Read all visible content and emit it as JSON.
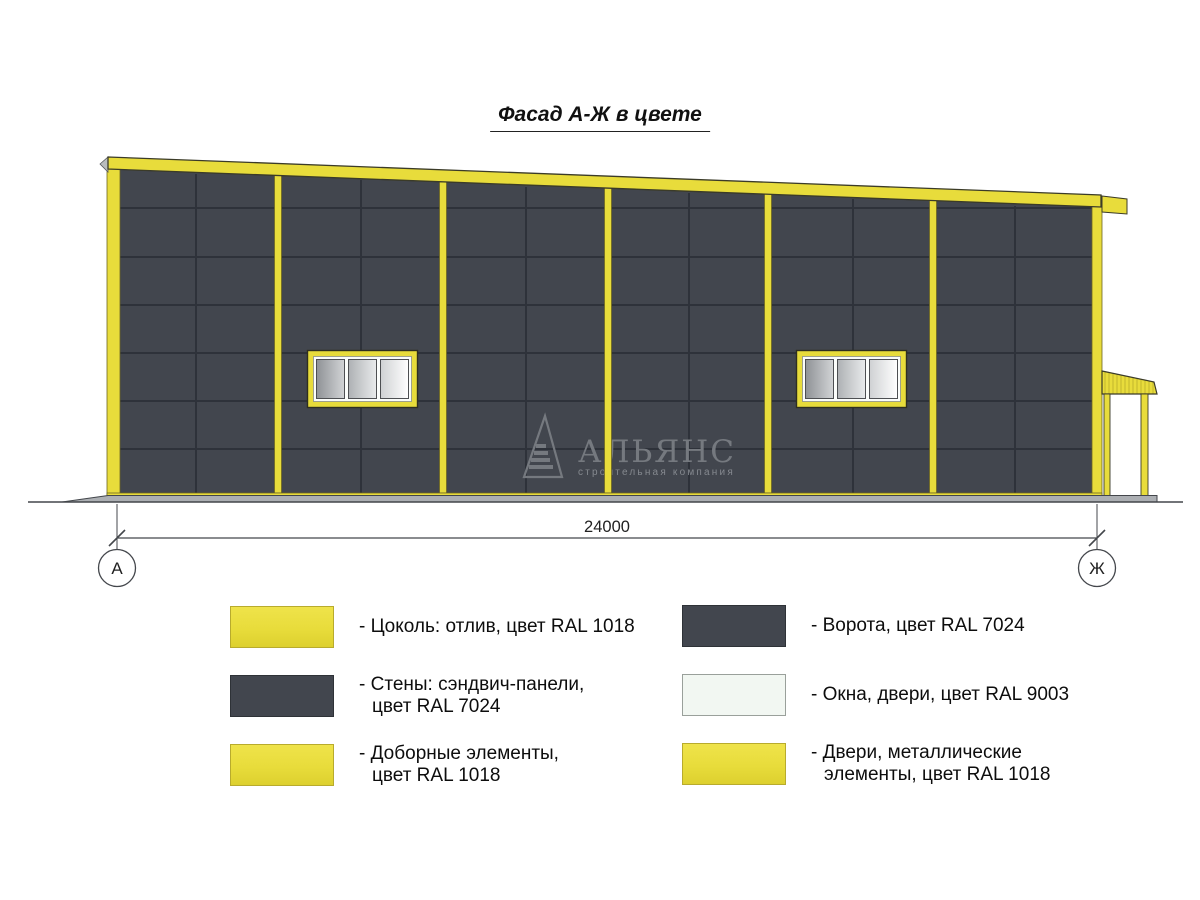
{
  "title": "Фасад А-Ж в цвете",
  "drawing": {
    "dimension_label": "24000",
    "axis_left": "А",
    "axis_right": "Ж",
    "watermark": {
      "name": "АЛЬЯНС",
      "subtitle": "строительная компания"
    }
  },
  "legend": {
    "items": [
      {
        "line1": "- Цоколь: отлив, цвет RAL 1018",
        "line2": "",
        "color": "#e8dc3b",
        "ral": "RAL 1018"
      },
      {
        "line1": "- Стены: сэндвич-панели,",
        "line2": "цвет RAL 7024",
        "color": "#42464e",
        "ral": "RAL 7024"
      },
      {
        "line1": "- Доборные элементы,",
        "line2": "цвет RAL 1018",
        "color": "#e8dc3b",
        "ral": "RAL 1018"
      },
      {
        "line1": "- Ворота, цвет RAL 7024",
        "line2": "",
        "color": "#42464e",
        "ral": "RAL 7024"
      },
      {
        "line1": "- Окна, двери, цвет RAL 9003",
        "line2": "",
        "color": "#f2f7f2",
        "ral": "RAL 9003"
      },
      {
        "line1": "- Двери, металлические",
        "line2": "элементы, цвет RAL 1018",
        "color": "#e8dc3b",
        "ral": "RAL 1018"
      }
    ]
  },
  "colors": {
    "accent_yellow_ral1018": "#e8dc3b",
    "wall_gray_ral7024": "#42464e",
    "window_white_ral9003": "#f2f7f2",
    "panel_joint": "#2e323a",
    "line_color": "#44474c",
    "ground_gray": "#acafb3",
    "watermark_gray": "#767a81"
  }
}
